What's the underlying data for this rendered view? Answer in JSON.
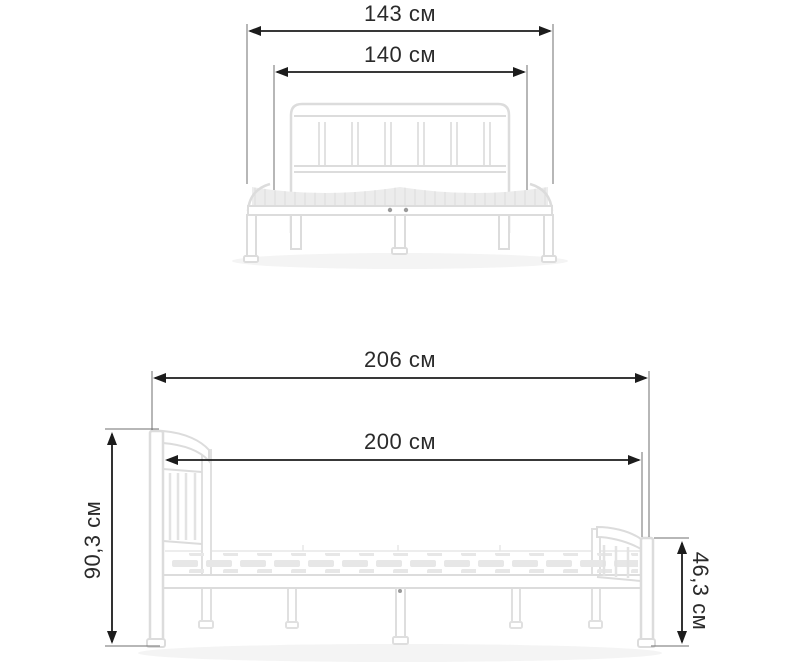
{
  "diagram": {
    "subject": "metal-bed-frame-dimensions",
    "views": [
      {
        "id": "front",
        "name": "headboard-front-view",
        "dimensions": [
          {
            "id": "overall-width",
            "label": "143 см"
          },
          {
            "id": "inner-width",
            "label": "140 см"
          }
        ]
      },
      {
        "id": "side",
        "name": "side-view",
        "dimensions": [
          {
            "id": "overall-length",
            "label": "206 см"
          },
          {
            "id": "inner-length",
            "label": "200 см"
          },
          {
            "id": "headboard-height",
            "label": "90,3 см"
          },
          {
            "id": "footboard-height",
            "label": "46,3 см"
          }
        ]
      }
    ],
    "colors": {
      "dimension_line": "#1c1c1c",
      "extension_line": "#6f6f6f",
      "label_text": "#2a2a2a",
      "bed_outline": "#dcdcdc",
      "bed_fill": "#ffffff",
      "slat_fill": "#e7e7e7",
      "shadow": "#f4f4f4"
    }
  }
}
